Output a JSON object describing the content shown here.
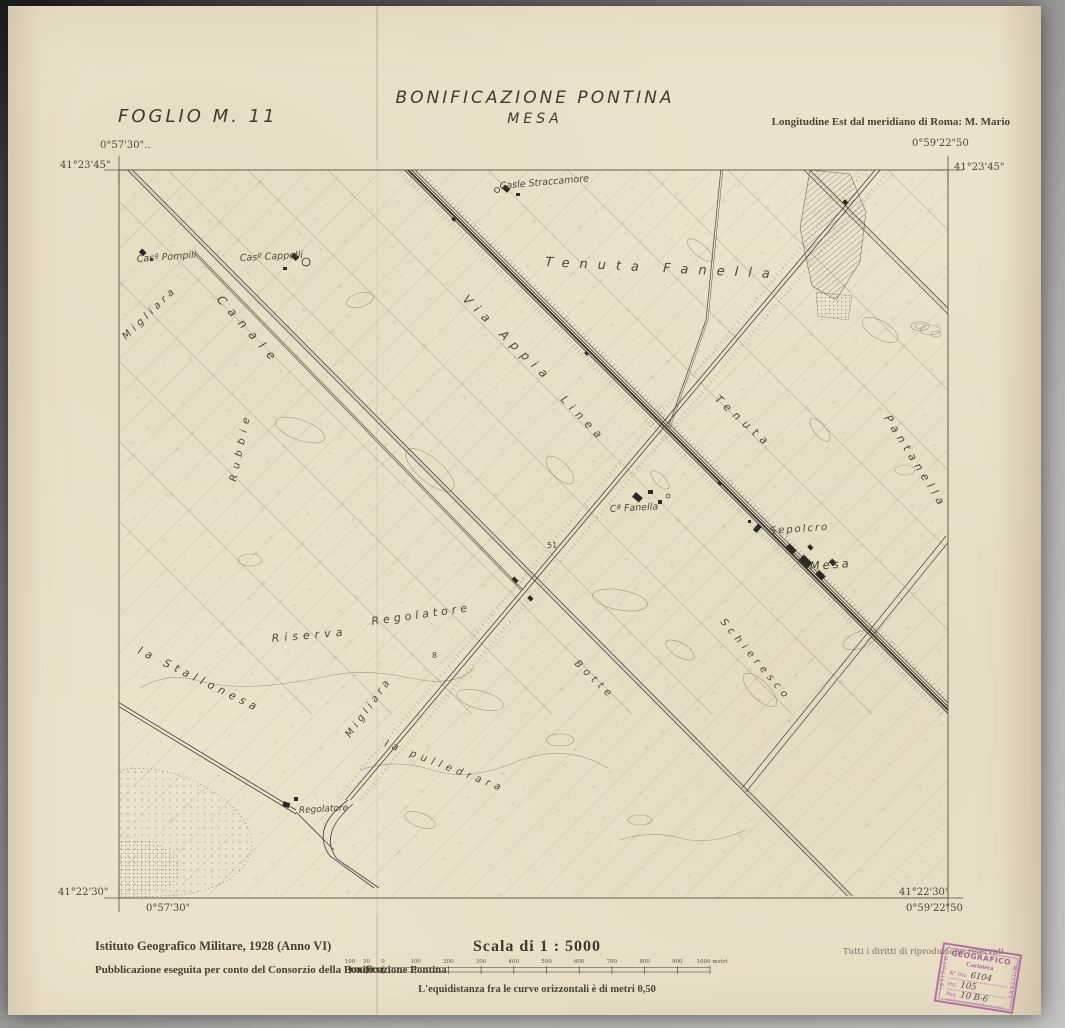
{
  "colors": {
    "paper": "#ece2cb",
    "ink": "#454033",
    "map_line": "#6f6553",
    "stamp_purple": "#9e5098"
  },
  "header": {
    "foglio": "FOGLIO  M. 11",
    "title": "BONIFICAZIONE  PONTINA",
    "subtitle": "MESA",
    "longitude_note": "Longitudine Est dal meridiano di Roma: M. Mario"
  },
  "corners": {
    "top_left_lon": "0°57'30\"..",
    "top_left_lat": "41°23'45\"",
    "top_right_lon": "0°59'22\"50",
    "top_right_lat": "41°23'45\"",
    "bottom_left_lat": "41°22'30\"",
    "bottom_left_lon": "0°57'30\"",
    "bottom_right_lat": "41°22'30\"",
    "bottom_right_lon": "0°59'22\"50"
  },
  "map_labels": {
    "straccamore": "Casle Straccamore",
    "pompili": "Casº Pompili",
    "cappelli": "Casº Cappelli",
    "tenuta_fanella": "Tenuta  Fanella",
    "via_appia": "Via Appia",
    "linea": "Linea",
    "canale": "Canale",
    "rubbie": "Rubbie",
    "migliara_nw": "Migliara",
    "migliara_sw": "Migliara",
    "tenuta": "Tenuta",
    "pantanella": "Pantanella",
    "riserva": "Riserva",
    "stallonesa": "la Stallonesa",
    "regolatore_center": "Regolatore",
    "regolatore_south": "Regolatore",
    "casa_fanella": "Cª Fanella",
    "sepolcro": "Sepolcro",
    "mesa": "Mesa",
    "pulledrara": "la pulledrara",
    "botte": "Botte",
    "schieresco": "Schieresco",
    "n51": "51",
    "n8": "8"
  },
  "footer": {
    "institute": "Istituto Geografico Militare, 1928  (Anno VI)",
    "publication": "Pubblicazione eseguita per conto del Consorzio della Bonificazione Pontina",
    "scale_title": "Scala di 1 : 5000",
    "equidistance": "L'equidistanza fra le curve orizzontali è di metri 0,50",
    "rights": "Tutti i diritti di riproduzione riservati",
    "scale_ticks": [
      "100",
      "50",
      "0",
      "100",
      "200",
      "300",
      "400",
      "500",
      "600",
      "700",
      "800",
      "900",
      "1000 metri"
    ]
  },
  "stamp": {
    "top": "GEOGRAFICO",
    "left": "ISTITUTO",
    "right": "MILITARE",
    "cartoteca": "Cartoteca",
    "inv_label": "N° Inv.",
    "inv_value": "6104",
    "ins_label": "Ins.",
    "ins_value": "105",
    "pos_label": "Pos.",
    "pos_value": "10 B-6"
  }
}
